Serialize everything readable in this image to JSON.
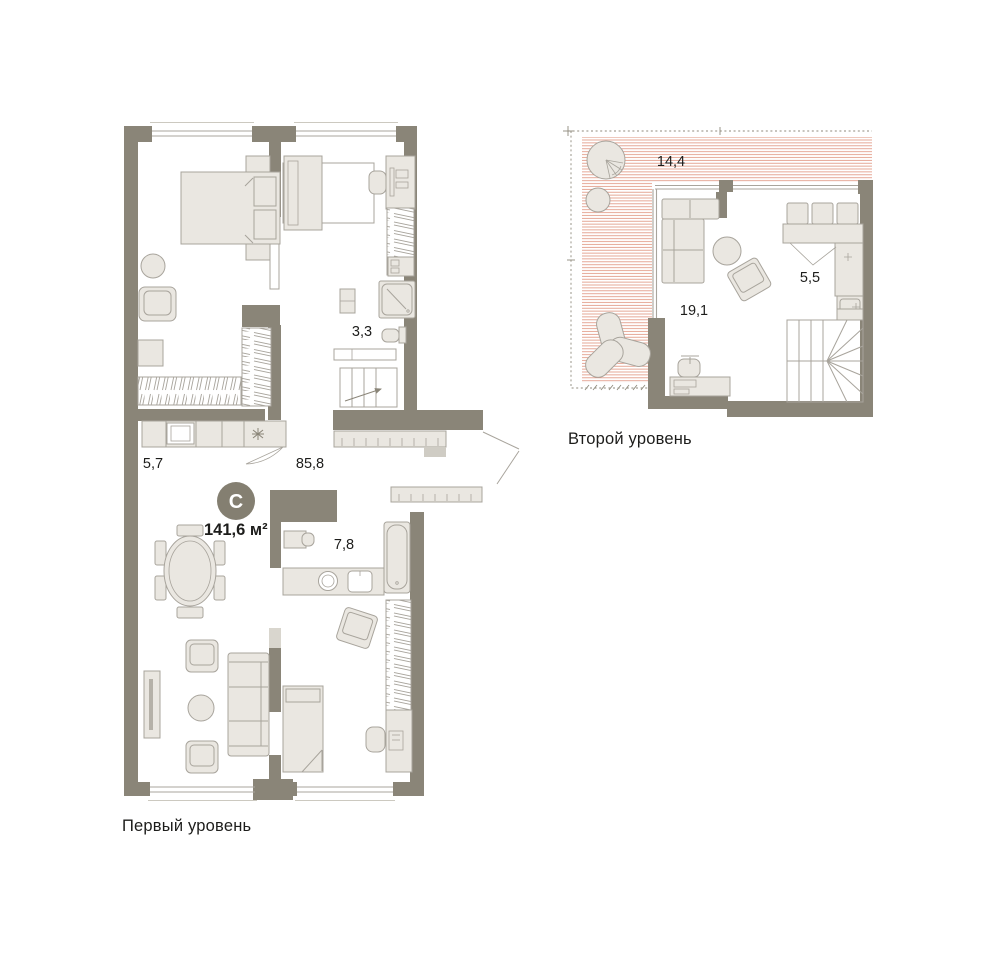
{
  "colors": {
    "wall": "#8a8578",
    "furniture_fill": "#eae7e1",
    "furniture_stroke": "#a8a49c",
    "light_panel": "#d9d6ce",
    "terrace_hatch": "#dd8a74",
    "dashed_line": "#8f8a7c",
    "text": "#1d1d1b",
    "badge_bg": "#847f71",
    "badge_text": "#ffffff"
  },
  "level1": {
    "caption": "Первый уровень",
    "type_badge": "С",
    "total_area": "141,6 м²",
    "areas": {
      "kitchen": "5,7",
      "living_room": "85,8",
      "bathroom_small": "3,3",
      "bathroom": "7,8"
    }
  },
  "level2": {
    "caption": "Второй уровень",
    "areas": {
      "terrace": "14,4",
      "lounge": "19,1",
      "kitchen": "5,5"
    }
  }
}
